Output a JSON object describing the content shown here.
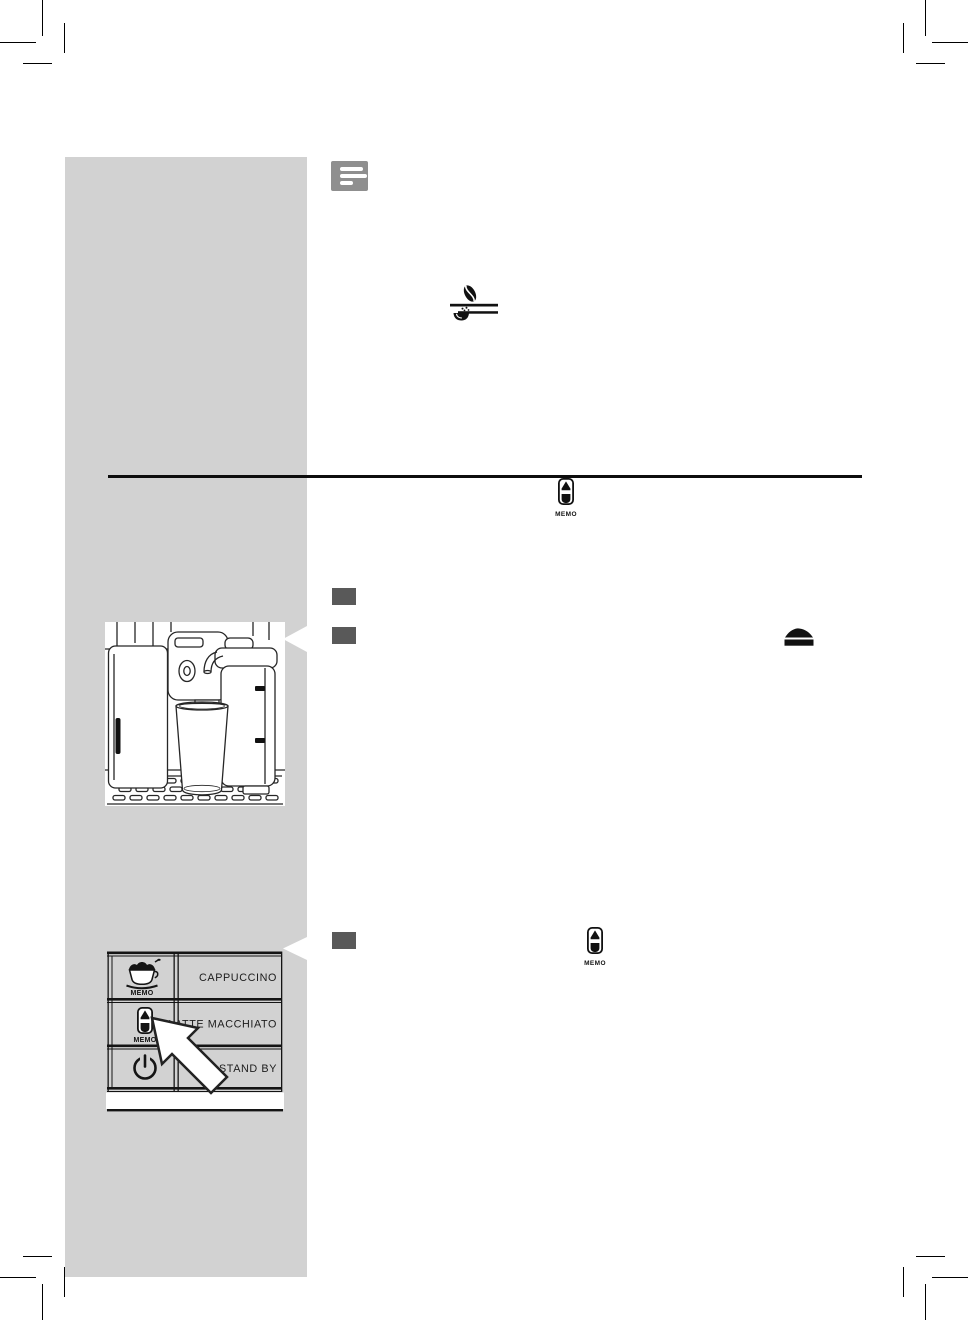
{
  "page": {
    "kind": "user-manual-page",
    "background": "#ffffff"
  },
  "colors": {
    "sidebar": "#d2d2d2",
    "note_icon_bg": "#8f8f8f",
    "step_box": "#595959",
    "line_black": "#111111"
  },
  "note": {
    "icon": "note-icon"
  },
  "top_icons": {
    "bean_selector": "coffee-bean-over-preground-icon",
    "ground_mound": "ground-coffee-mound-icon"
  },
  "memo_callouts": [
    {
      "icon": "latte-macchiato-glass-icon",
      "label": "MEMO"
    },
    {
      "icon": "latte-macchiato-glass-icon",
      "label": "MEMO"
    }
  ],
  "steps": [
    {
      "label": ""
    },
    {
      "label": ""
    },
    {
      "label": ""
    }
  ],
  "illustrations": {
    "machine": {
      "description": "espresso machine with milk carafe and tall glass on drip tray",
      "icon": "coffee-machine-drawing"
    },
    "control_panel": {
      "buttons": [
        {
          "icon": "cappuccino-cup-memo-icon",
          "memo_label": "MEMO",
          "label": "CAPPUCCINO"
        },
        {
          "icon": "latte-macchiato-glass-memo-icon",
          "memo_label": "MEMO",
          "label": "LATTE MACCHIATO"
        },
        {
          "icon": "power-icon",
          "memo_label": "",
          "label": "STAND BY"
        }
      ],
      "pointer": "arrow-pointer-to-latte-macchiato-button"
    }
  }
}
